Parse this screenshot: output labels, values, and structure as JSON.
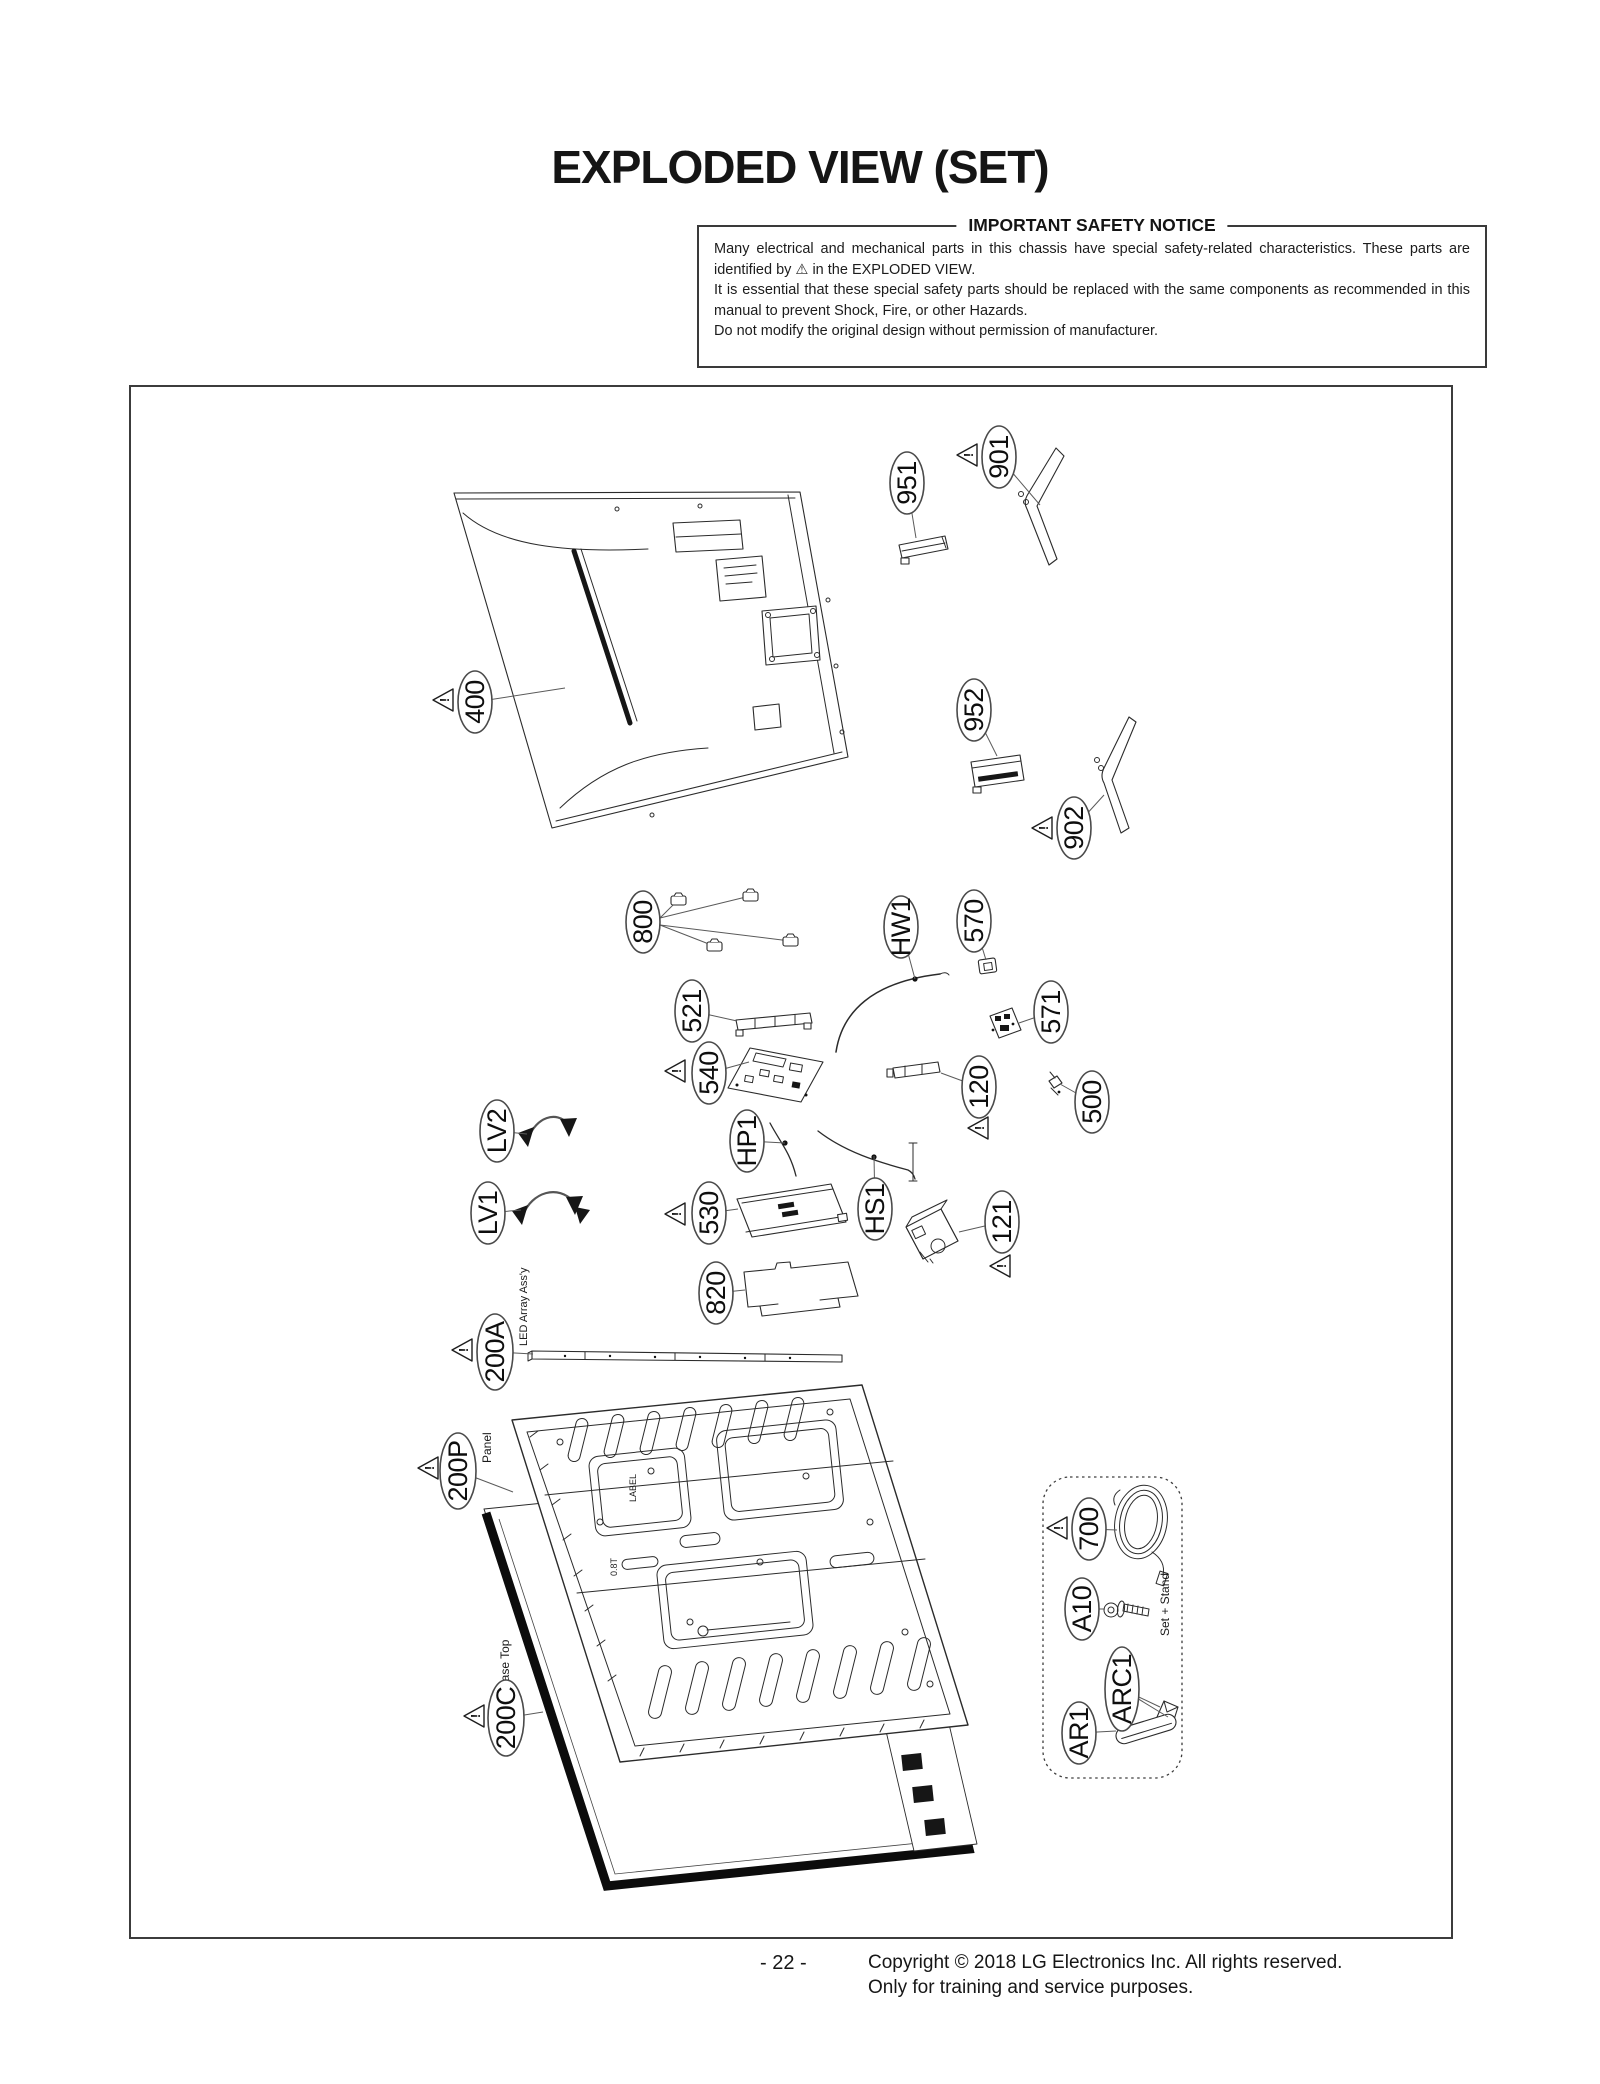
{
  "page": {
    "title": "EXPLODED VIEW (SET)",
    "page_number": "- 22 -",
    "copyright_line1": "Copyright © 2018 LG Electronics Inc. All rights reserved.",
    "copyright_line2": "Only for training and service purposes."
  },
  "safety_notice": {
    "heading": "IMPORTANT SAFETY NOTICE",
    "p1": "Many electrical and mechanical parts in this chassis have special safety-related characteristics. These parts are identified by  ⚠  in the EXPLODED VIEW.",
    "p2": "It is essential that these special safety parts should be replaced with the same components as recommended in this manual to prevent Shock, Fire, or other Hazards.",
    "p3": "Do not modify the original design without permission of manufacturer."
  },
  "callouts": {
    "c951": "951",
    "c901": "901",
    "c400": "400",
    "c952": "952",
    "c902": "902",
    "c800": "800",
    "cHW1": "HW1",
    "c570": "570",
    "c571": "571",
    "c521": "521",
    "c540": "540",
    "c120": "120",
    "c500": "500",
    "cLV2": "LV2",
    "cLV1": "LV1",
    "cHP1": "HP1",
    "c530": "530",
    "cHS1": "HS1",
    "c121": "121",
    "c820": "820",
    "c200A": "200A",
    "c200P": "200P",
    "c700": "700",
    "cA10": "A10",
    "cARC1": "ARC1",
    "cAR1": "AR1",
    "c200C": "200C"
  },
  "sub_labels": {
    "led_array": "LED Array Ass'y",
    "panel": "Panel",
    "case_top": "Case Top",
    "set_stand": "Set + Stand"
  },
  "diagram_texts": {
    "label": "LABEL",
    "thickness": "0.8T"
  },
  "misc": {
    "warning_mark": "!"
  }
}
